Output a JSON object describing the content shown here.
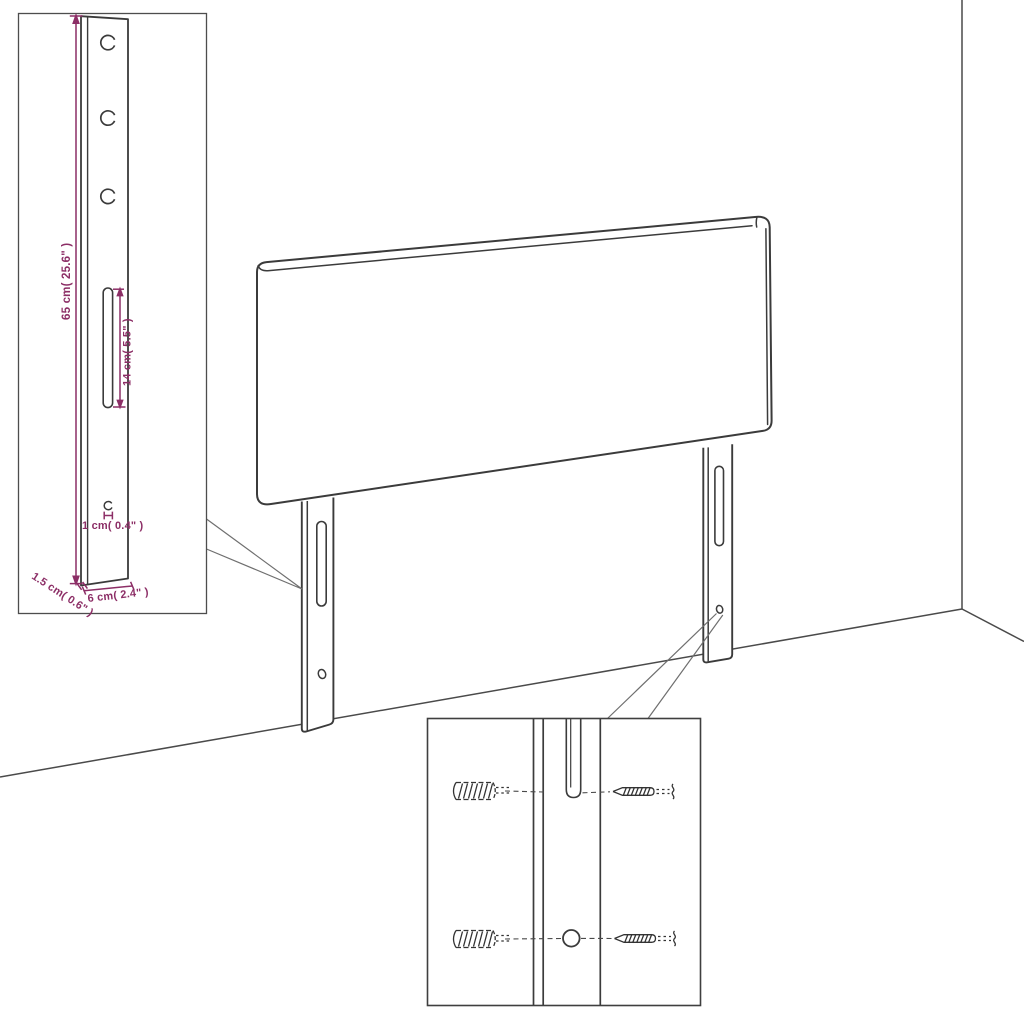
{
  "diagram": {
    "background": "#ffffff",
    "line_color": "#3b3b3b",
    "box_border_color": "#4d4d4d",
    "callout_color": "#6f6f6f",
    "dimension_color": "#8c2e66",
    "labels": {
      "leg_height": "65 cm( 25.6\" )",
      "slot_length": "14 cm( 5.5\" )",
      "hole_diameter": "1 cm( 0.4\" )",
      "leg_thickness": "1.5 cm( 0.6\" )",
      "leg_width": "6 cm( 2.4\" )"
    }
  }
}
